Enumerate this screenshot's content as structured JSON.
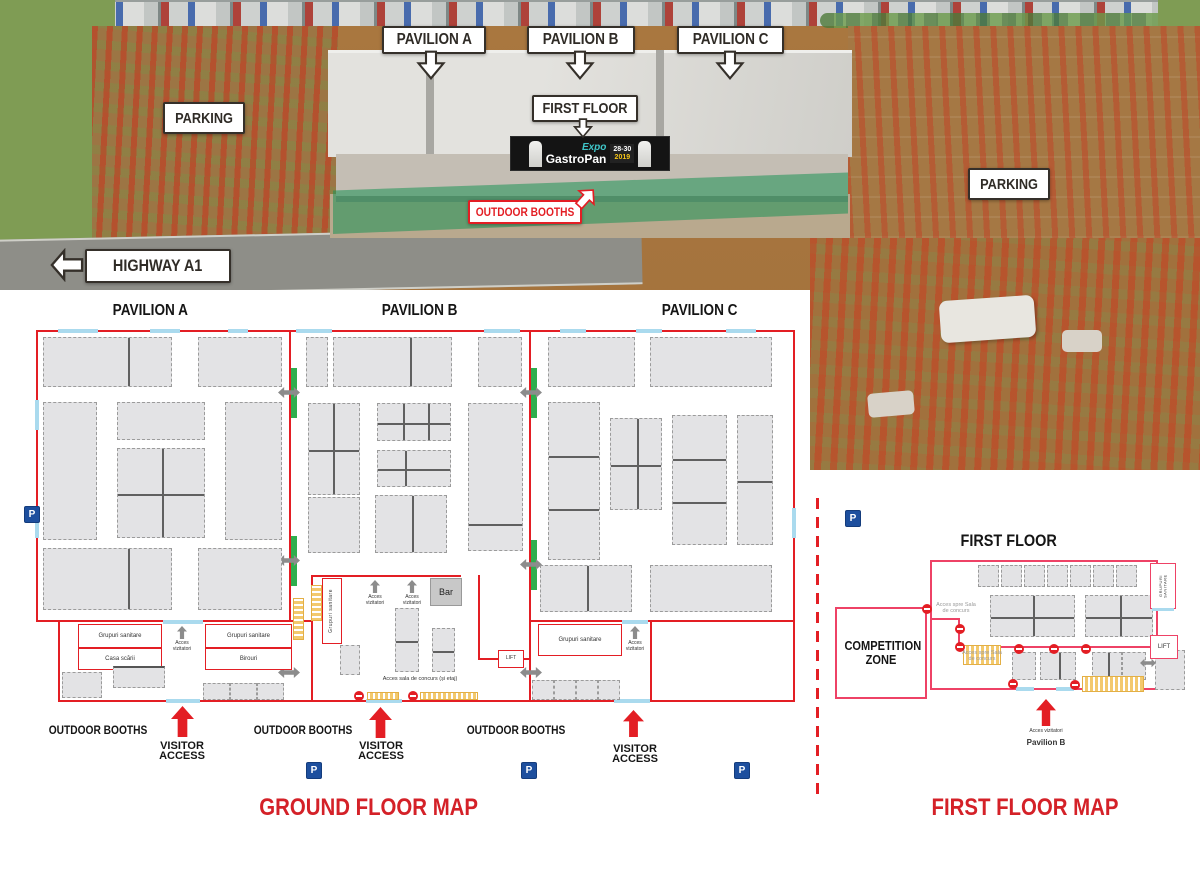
{
  "photo": {
    "pavilion_a": "PAVILION A",
    "pavilion_b": "PAVILION B",
    "pavilion_c": "PAVILION C",
    "first_floor": "FIRST FLOOR",
    "parking": "PARKING",
    "highway": "HIGHWAY A1",
    "outdoor_booths": "OUTDOOR BOOTHS",
    "banner": {
      "brand_expo": "Expo",
      "brand_gastropan": "GastroPan",
      "dates": "28-30",
      "year": "2019"
    }
  },
  "ground_floor": {
    "title": "GROUND FLOOR MAP",
    "pavilion_a": "PAVILION A",
    "pavilion_b": "PAVILION B",
    "pavilion_c": "PAVILION C",
    "rooms": {
      "grupuri_sanitare": "Grupuri sanitare",
      "casa_scarii": "Casa scării",
      "birouri": "Birouri",
      "bar": "Bar",
      "lift": "LIFT"
    },
    "labels": {
      "acces_vizitatori": "Acces vizitatori",
      "acces_sala_concurs": "Acces sala de concurs (și etaj)",
      "outdoor_booths": "OUTDOOR BOOTHS",
      "visitor_access": "VISITOR ACCESS",
      "parking_symbol": "P"
    }
  },
  "first_floor": {
    "title": "FIRST FLOOR",
    "map_title": "FIRST FLOOR MAP",
    "competition_zone": "COMPETITION ZONE",
    "labels": {
      "acces_spre_sala": "Acces spre Sala de concurs",
      "grupuri_sanitare": "GRUPURI SANITARE",
      "lift": "LIFT",
      "acces_vizitatori": "Acces vizitatori",
      "pavilion_b": "Pavilion B"
    }
  },
  "colors": {
    "map_red": "#e31e24",
    "first_floor_pink": "#ee4266",
    "title_red": "#d42128",
    "booth_gray": "#e3e3e5",
    "door_blue": "#aadaee",
    "connector_green": "#2eae4d",
    "parking_blue": "#1d4f9e",
    "stairs_yellow": "#f3c96d",
    "callout_dark": "#35302a"
  }
}
